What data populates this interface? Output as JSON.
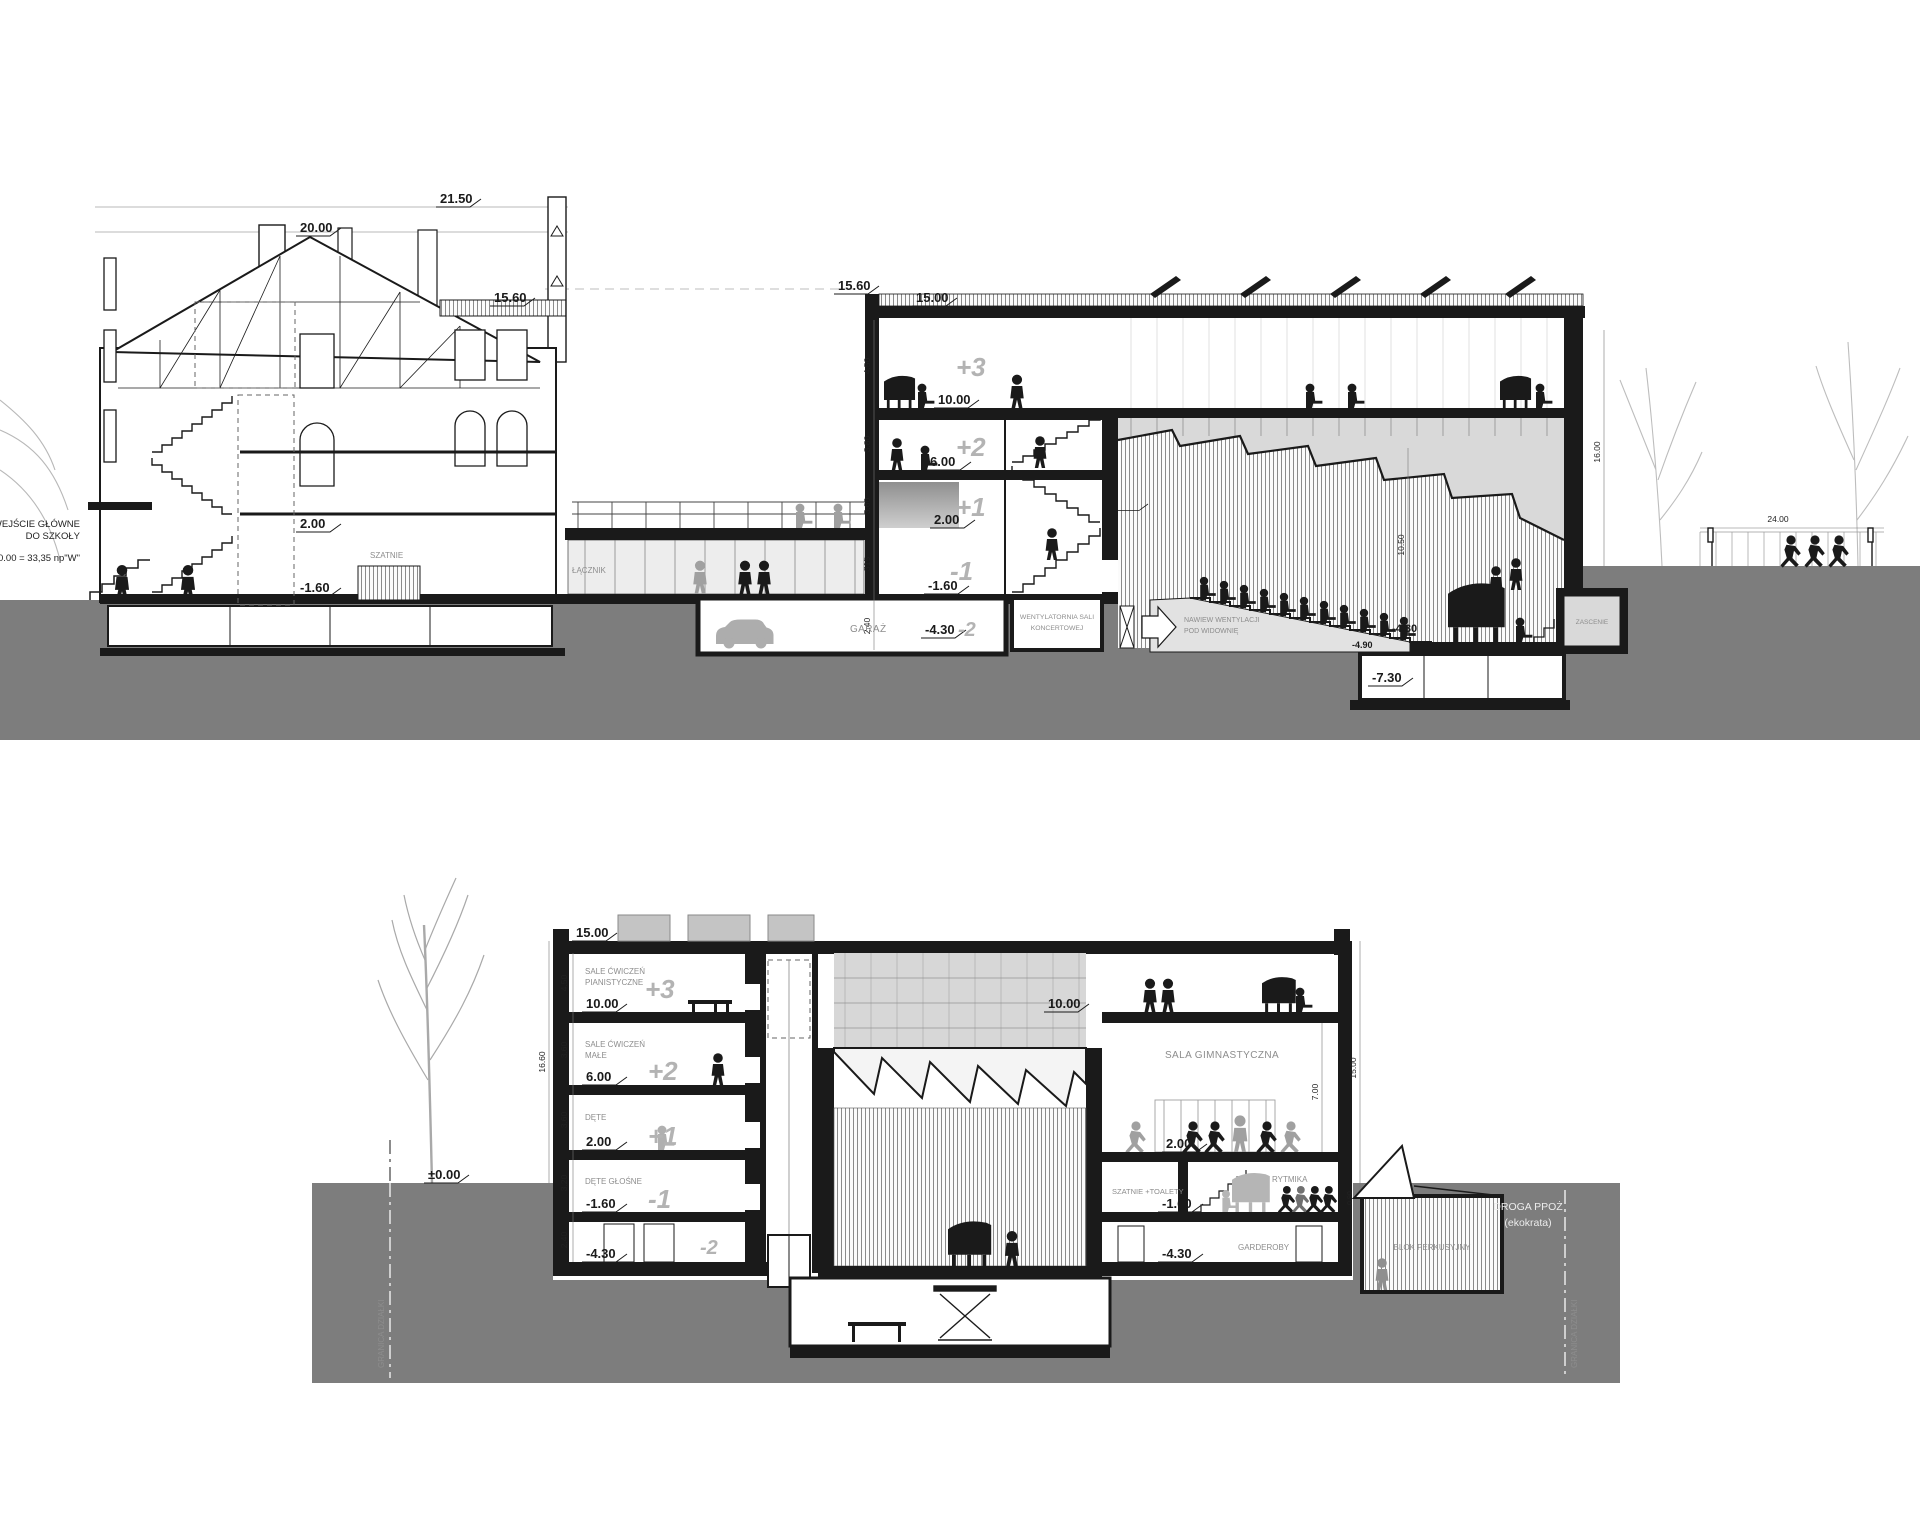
{
  "colors": {
    "ground": "#7d7d7d",
    "line": "#1a1a1a",
    "light_fill": "#d9d9d9",
    "silhouette": "#1a1a1a",
    "silhouette_gray": "#a0a0a0",
    "tag_gray": "#b3b3b3",
    "label_gray": "#8d8d8d"
  },
  "top": {
    "ann": {
      "entrance1": "WEJŚCIE GŁÓWNE",
      "entrance2": "DO SZKOŁY",
      "datum": "0.00 = 33,35 np\"W\""
    },
    "levels": {
      "a2150": "21.50",
      "a2000": "20.00",
      "a1560old": "15.60",
      "a1560": "15.60",
      "a1500": "15.00",
      "a1000": "10.00",
      "a600": "6.00",
      "a200": "2.00",
      "am160": "-1.60",
      "a200old": "2.00",
      "am160old": "-1.60",
      "am430g": "-4.30",
      "am430": "-4.30",
      "am490": "-4.90",
      "am730": "-7.30"
    },
    "tags": {
      "p3": "+3",
      "p2": "+2",
      "p1": "+1",
      "m1": "-1",
      "m2": "-2"
    },
    "dims": {
      "h450": "4.50",
      "h380": "3.80",
      "h360": "3.60",
      "h315": "315",
      "h240": "2.40",
      "hall": "10.50",
      "right": "16.00",
      "court": "24.00"
    },
    "rooms": {
      "szatnie": "SZATNIE",
      "lacznik": "ŁĄCZNIK",
      "garaz": "GARAŻ",
      "went1": "WENTYLATORNIA SALI",
      "went2": "KONCERTOWEJ",
      "naw1": "NAWIEW WENTYLACJI",
      "naw2": "POD WIDOWNIĘ",
      "zascenie": "ZASCENIE"
    }
  },
  "bottom": {
    "levels": {
      "a1500": "15.00",
      "a1000l": "10.00",
      "a1000r": "10.00",
      "a600": "6.00",
      "a200l": "2.00",
      "a200r": "2.00",
      "am160l": "-1.60",
      "am160r": "-1.60",
      "am430l": "-4.30",
      "am430r": "-4.30",
      "zero": "±0.00"
    },
    "tags": {
      "p3": "+3",
      "p2": "+2",
      "p1": "+1",
      "m1": "-1",
      "m2": "-2"
    },
    "dims": {
      "h450": "4.50",
      "h360a": "3.60",
      "h360b": "3.60",
      "h320": "3.20",
      "h240": "2.40",
      "total": "16.60",
      "right": "15.00",
      "gym": "7.00",
      "small": "0.90"
    },
    "rooms": {
      "r3a": "SALE ĆWICZEŃ",
      "r3b": "PIANISTYCZNE",
      "r2a": "SALE ĆWICZEŃ",
      "r2b": "MAŁE",
      "r1": "DĘTE",
      "rm1": "DĘTE GŁOŚNE",
      "gym": "SALA GIMNASTYCZNA",
      "rytmika": "RYTMIKA",
      "szatnie": "SZATNIE +TOALETY",
      "garderoby": "GARDEROBY",
      "perkusja": "BLOK PERKUSYJNY"
    },
    "site": {
      "granicaL": "GRANICA DZIAŁKI",
      "granicaR": "GRANICA DZIAŁKI",
      "droga1": "DROGA PPOŻ",
      "droga2": "(ekokrata)"
    }
  }
}
